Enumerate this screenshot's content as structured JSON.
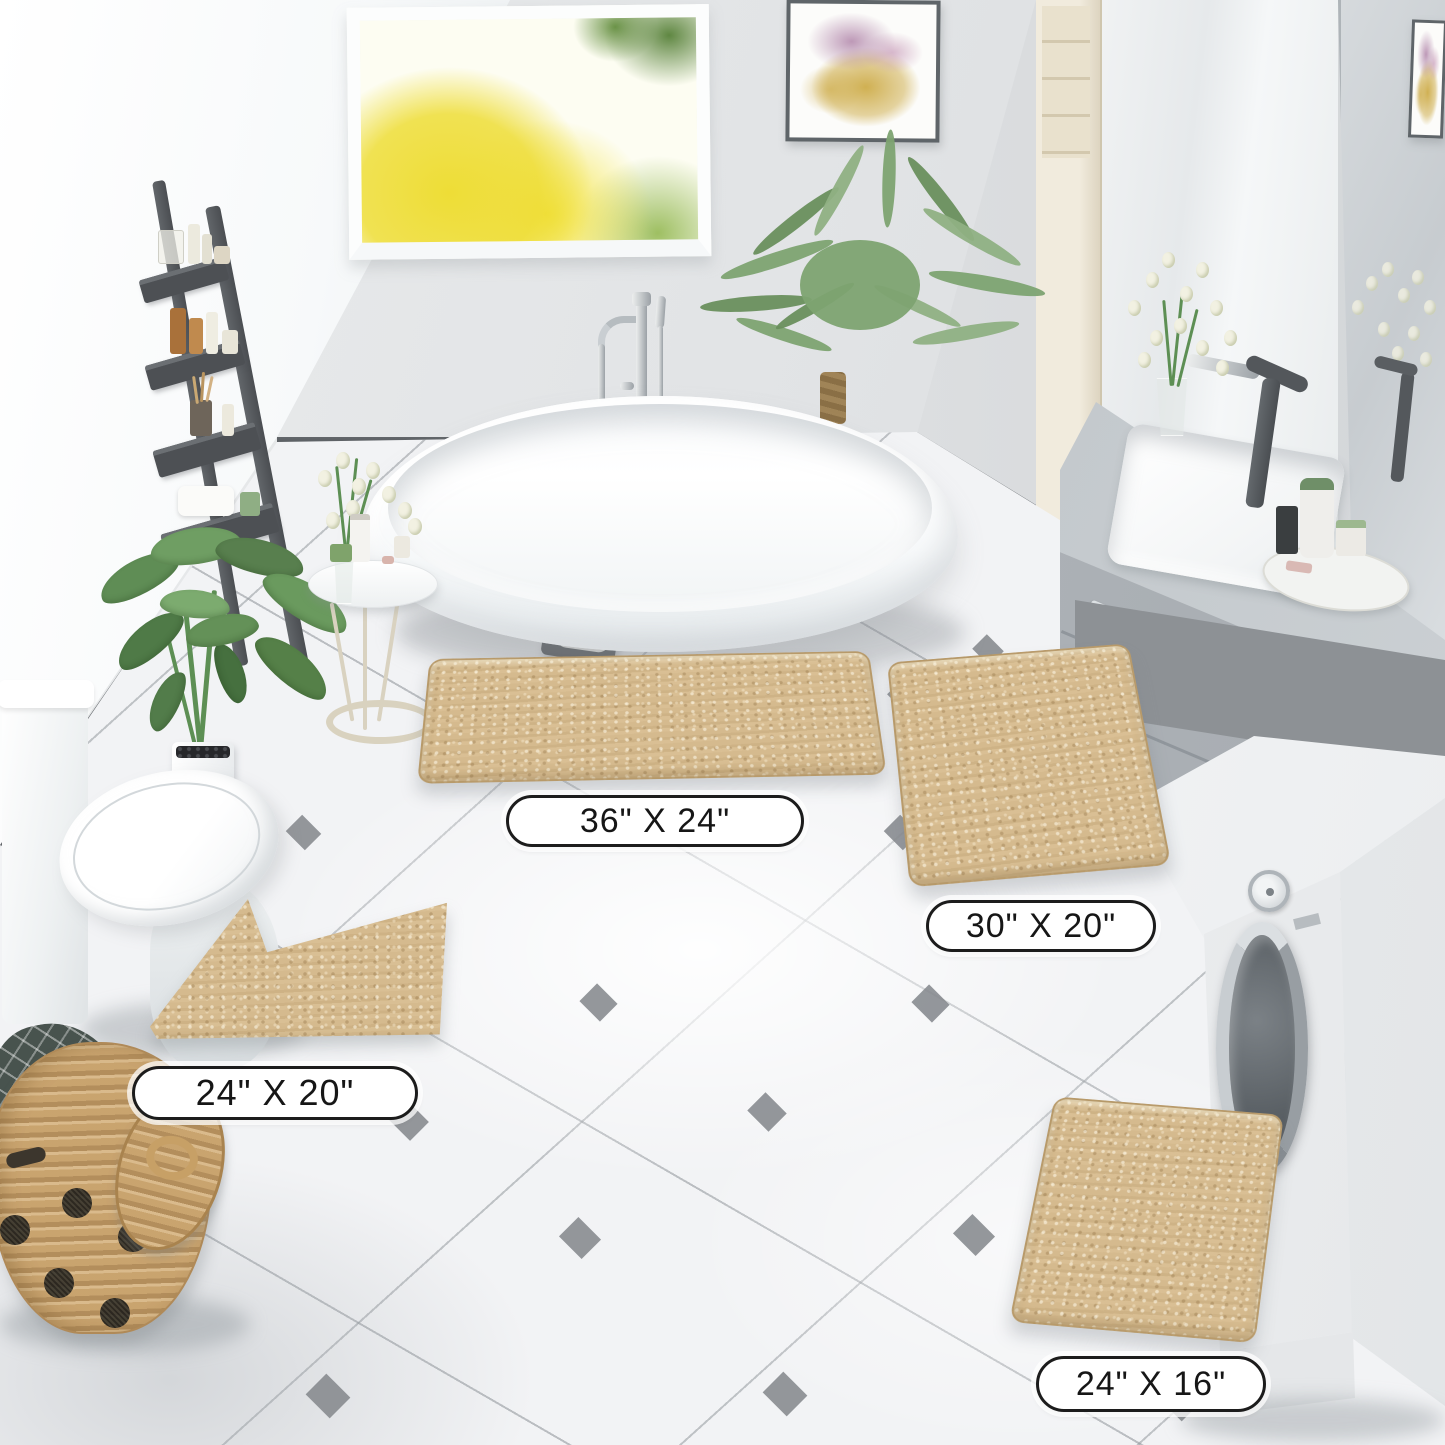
{
  "scene": {
    "description": "Bathroom product photo of a four-piece beige chenille bath mat set",
    "labels": [
      {
        "id": "mat-36x24",
        "text": "36\" X 24\""
      },
      {
        "id": "mat-30x20",
        "text": "30\" X 20\""
      },
      {
        "id": "mat-24x20",
        "text": "24\" X 20\""
      },
      {
        "id": "mat-24x16",
        "text": "24\" X 16\""
      }
    ],
    "colors": {
      "mat_beige": "#d5ba8e",
      "mat_edge": "#b09261",
      "wall_gray": "#e2e4e6",
      "wall_white": "#f8fafb",
      "floor": "#f2f3f5",
      "tile_line": "#9aa0a4",
      "tile_diamond": "#85898d",
      "baseboard": "#54585c",
      "ladder_gray": "#54575b",
      "tub_white": "#ffffff",
      "chrome": "#c3c8cc",
      "faucet_dark": "#53575b",
      "plant_green": "#6f9a63",
      "palm_green": "#7da371",
      "window_yellow": "#eedd36",
      "basket_tan": "#cda873",
      "basket_dot": "#2d2b26",
      "cream_unit": "#f1ebdd",
      "counter_gray": "#cdd2d6",
      "cabinet_gray": "#b0b5ba",
      "washer_white": "#f5f6f7",
      "mirror_gray": "#ced3d7",
      "art_gold": "#d0b052",
      "art_purple": "#b287ab",
      "label_bg": "#ffffff",
      "label_border": "#1c1c1c",
      "label_text": "#161616"
    }
  }
}
